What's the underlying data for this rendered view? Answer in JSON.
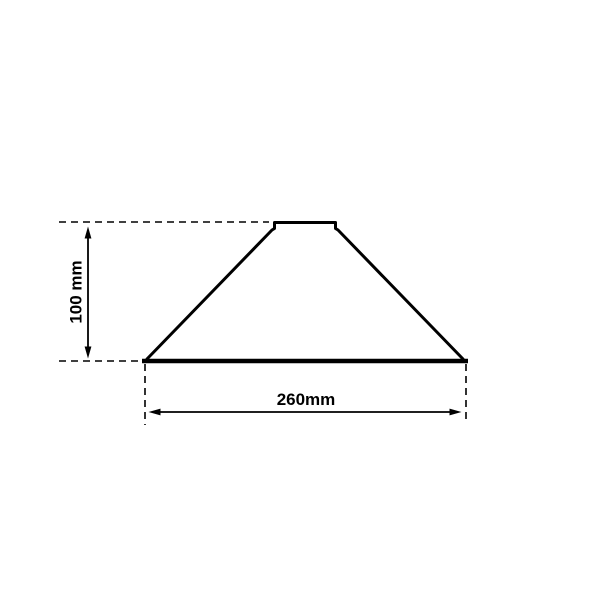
{
  "colors": {
    "line": "#000000",
    "background": "#ffffff"
  },
  "drawing": {
    "type": "technical-dimension-drawing",
    "subject": "cone lampshade cross-section with neck collar",
    "dimensions": {
      "height": {
        "label": "100 mm",
        "value": 100,
        "unit": "mm",
        "orientation": "vertical"
      },
      "width": {
        "label": "260mm",
        "value": 260,
        "unit": "mm",
        "orientation": "horizontal"
      }
    }
  }
}
